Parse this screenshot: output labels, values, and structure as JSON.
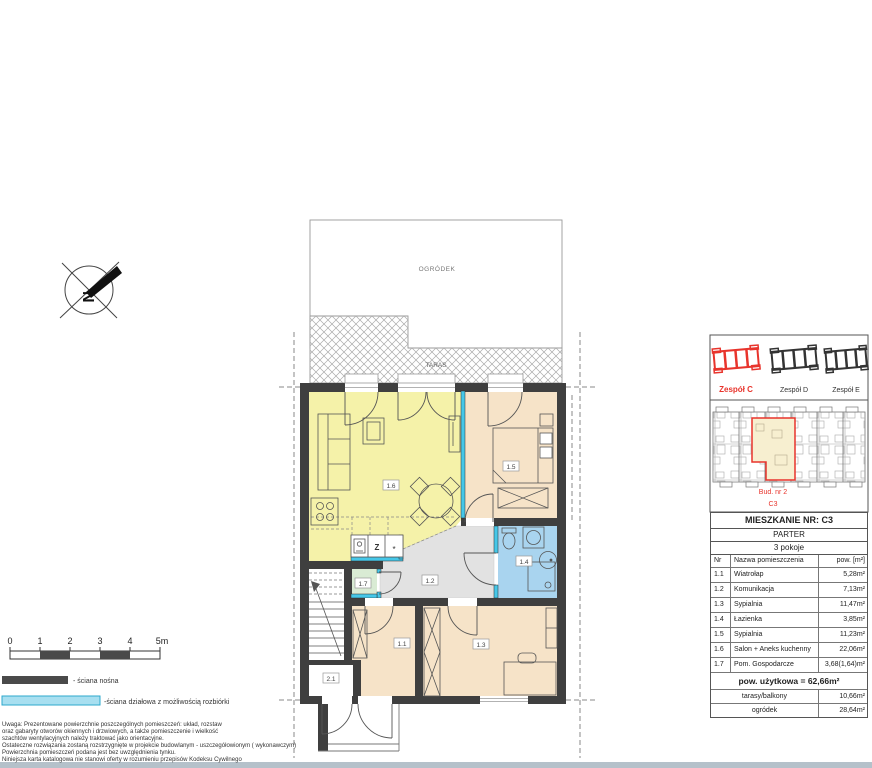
{
  "plan": {
    "garden_label": "OGRÓDEK",
    "terrace_label": "TARAS",
    "compass_label": "N",
    "rooms": {
      "r11": "1.1",
      "r12": "1.2",
      "r13": "1.3",
      "r14": "1.4",
      "r15": "1.5",
      "r16": "1.6",
      "r17": "1.7",
      "r21": "2.1"
    },
    "kitchen": {
      "sink": "Z",
      "hob": "*"
    }
  },
  "scalebar": {
    "ticks": [
      "0",
      "1",
      "2",
      "3",
      "4",
      "5m"
    ]
  },
  "legend": {
    "load_wall": "- ściana nośna",
    "load_wall_color": "#4a4a4a",
    "partition_wall": "-ściana działowa z możliwością rozbiórki",
    "partition_wall_color": "#a8dff0"
  },
  "notes": [
    "Uwaga: Prezentowane powierzchnie poszczególnych pomieszczeń: układ, rozstaw",
    "oraz gabaryty otworów okiennych i drzwiowych, a także pomieszczenie i wielkość",
    "szachtów wentylacyjnych należy traktować jako orientacyjne.",
    "Ostateczne rozwiązania zostaną rozstrzygnięte w projekcie budowlanym - uszczegółowionym ( wykonawczym)",
    "Powierzchnia pomieszczeń podana jest bez uwzględnienia tynku.",
    "Niniejsza karta katalogowa nie stanowi oferty w rozumieniu przepisów Kodeksu Cywilnego"
  ],
  "panel": {
    "groups": [
      {
        "label": "Zespół C"
      },
      {
        "label": "Zespół D"
      },
      {
        "label": "Zespół E"
      }
    ],
    "highlight_color": "#e8342c",
    "building_label": "Bud. nr 2",
    "unit_label": "C3",
    "title": "MIESZKANIE NR: C3",
    "floor": "PARTER",
    "rooms_count": "3 pokoje",
    "table": {
      "headers": [
        "Nr",
        "Nazwa pomieszczenia",
        "pow. [m²]"
      ],
      "rows": [
        {
          "nr": "1.1",
          "name": "Wiatrołap",
          "area": "5,28m²"
        },
        {
          "nr": "1.2",
          "name": "Komunikacja",
          "area": "7,13m²"
        },
        {
          "nr": "1.3",
          "name": "Sypialnia",
          "area": "11,47m²"
        },
        {
          "nr": "1.4",
          "name": "Łazienka",
          "area": "3,85m²"
        },
        {
          "nr": "1.5",
          "name": "Sypialnia",
          "area": "11,23m²"
        },
        {
          "nr": "1.6",
          "name": "Salon + Aneks kuchenny",
          "area": "22,06m²"
        },
        {
          "nr": "1.7",
          "name": "Pom. Gospodarcze",
          "area": "3,68(1,64)m²"
        }
      ],
      "total": "pow. użytkowa = 62,66m²",
      "extras": [
        {
          "name": "tarasy/balkony",
          "area": "10,66m²"
        },
        {
          "name": "ogródek",
          "area": "28,64m²"
        }
      ]
    }
  }
}
